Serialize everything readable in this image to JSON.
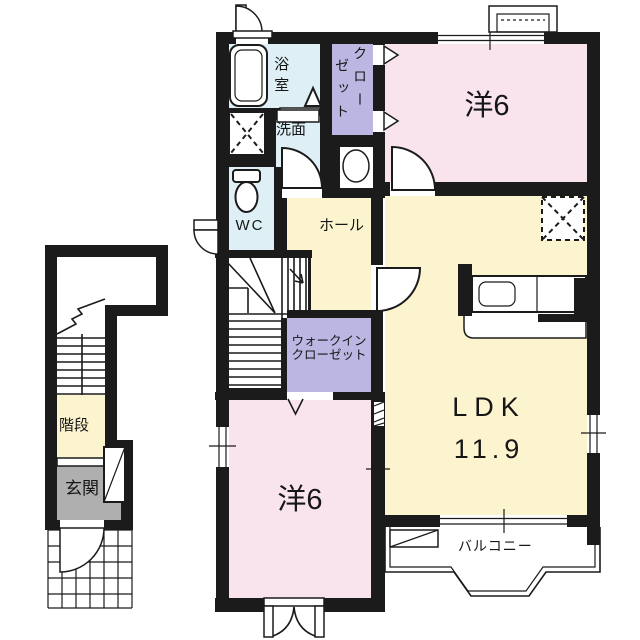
{
  "plan_title": "2F apartment floor plan",
  "colors": {
    "wall": "#1b1b1b",
    "line": "#1b1b1b",
    "pink": "#f9e4ee",
    "yellow": "#fcf4cf",
    "blue": "#def0f5",
    "purple": "#bcb6e3",
    "gray": "#b0afaf"
  },
  "rooms": {
    "bathroom": {
      "label": "浴室"
    },
    "closet": {
      "label": "クローゼット",
      "col1": "クロー",
      "col2": "ゼット"
    },
    "washroom": {
      "label": "洗面"
    },
    "toilet": {
      "label": "WC"
    },
    "hall": {
      "label": "ホール"
    },
    "western_room_top": {
      "label": "洋6"
    },
    "ldk": {
      "label": "LDK",
      "area": "11.9"
    },
    "walk_in_closet": {
      "line1": "ウォークイン",
      "line2": "クローゼット"
    },
    "western_room_bottom": {
      "label": "洋6"
    },
    "balcony": {
      "label": "バルコニー"
    },
    "staircase": {
      "label": "階段"
    },
    "entrance": {
      "label": "玄関"
    }
  }
}
